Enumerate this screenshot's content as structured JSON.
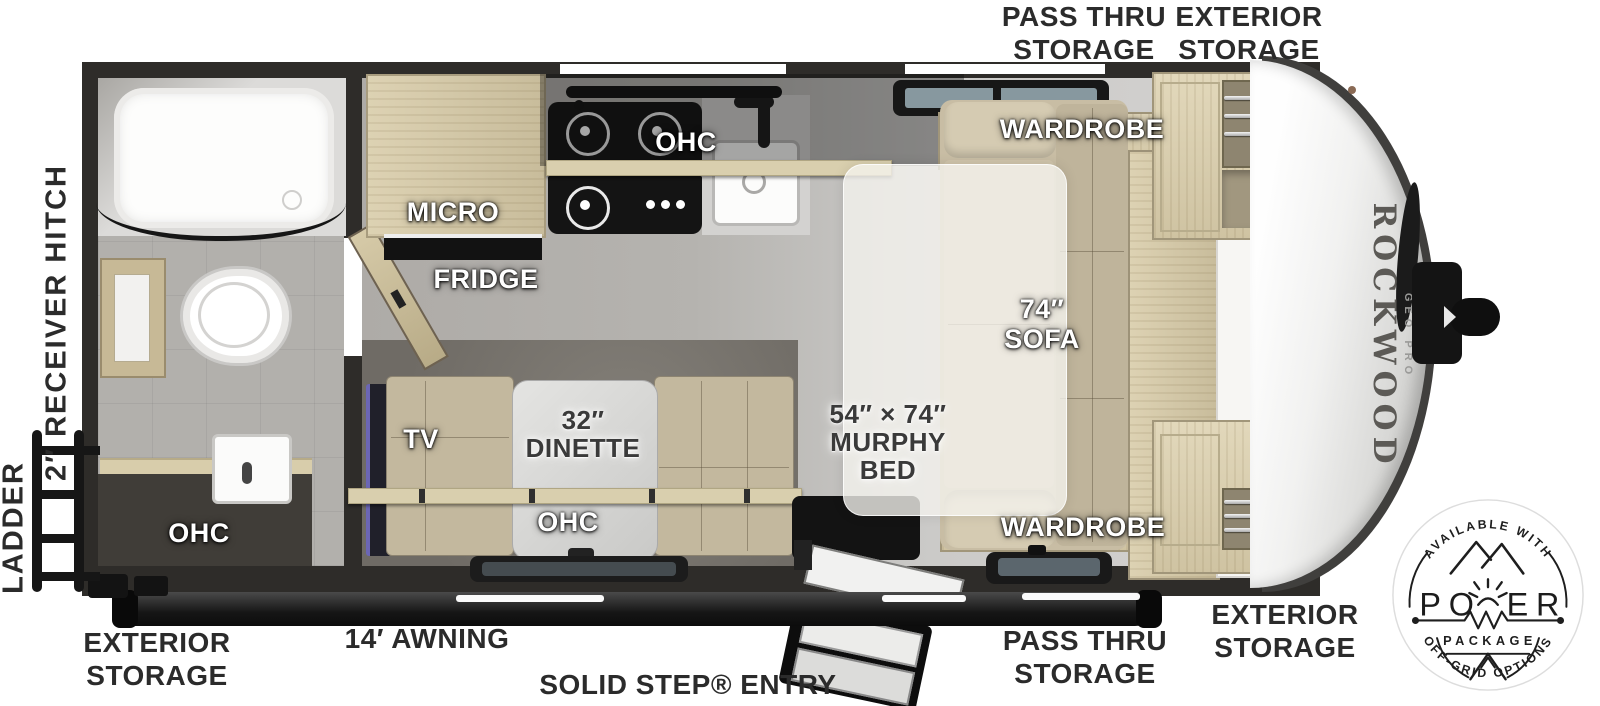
{
  "doc": {
    "title": "Rockwood Geo Pro travel trailer floor plan"
  },
  "callouts": {
    "top_pass_thru": [
      "PASS THRU",
      "STORAGE"
    ],
    "top_exterior": [
      "EXTERIOR",
      "STORAGE"
    ],
    "left_receiver_hitch": "2″ RECEIVER HITCH",
    "left_ladder": "LADDER",
    "bottom_exterior_left": [
      "EXTERIOR",
      "STORAGE"
    ],
    "bottom_awning": "14′ AWNING",
    "bottom_solid_step": "SOLID STEP® ENTRY",
    "bottom_pass_thru": [
      "PASS THRU",
      "STORAGE"
    ],
    "bottom_exterior_right": [
      "EXTERIOR",
      "STORAGE"
    ]
  },
  "features": {
    "bath_ohc": "OHC",
    "micro": "MICRO",
    "fridge": "FRIDGE",
    "kitchen_ohc": "OHC",
    "tv": "TV",
    "dinette": [
      "32″",
      "DINETTE"
    ],
    "dinette_ohc": "OHC",
    "murphy_bed": [
      "54″ × 74″",
      "MURPHY",
      "BED"
    ],
    "sofa": [
      "74″",
      "SOFA"
    ],
    "wardrobe_top": "WARDROBE",
    "wardrobe_bottom": "WARDROBE"
  },
  "brand": {
    "name": "ROCKWOOD",
    "series": "GEO PRO"
  },
  "badge": {
    "arc_top": "AVAILABLE WITH",
    "power_left": "PO",
    "power_right": "ER",
    "package": "PACKAGE",
    "arc_bottom": "OFF-GRID OPTIONS"
  },
  "colors": {
    "label_ink": "#2b2b2b",
    "wall": "#2e2c29",
    "wood": "#d9cfb0",
    "cushion": "#c3b89e",
    "badge_ink": "#1e1e1e",
    "floor_tile": "#b1afab"
  }
}
